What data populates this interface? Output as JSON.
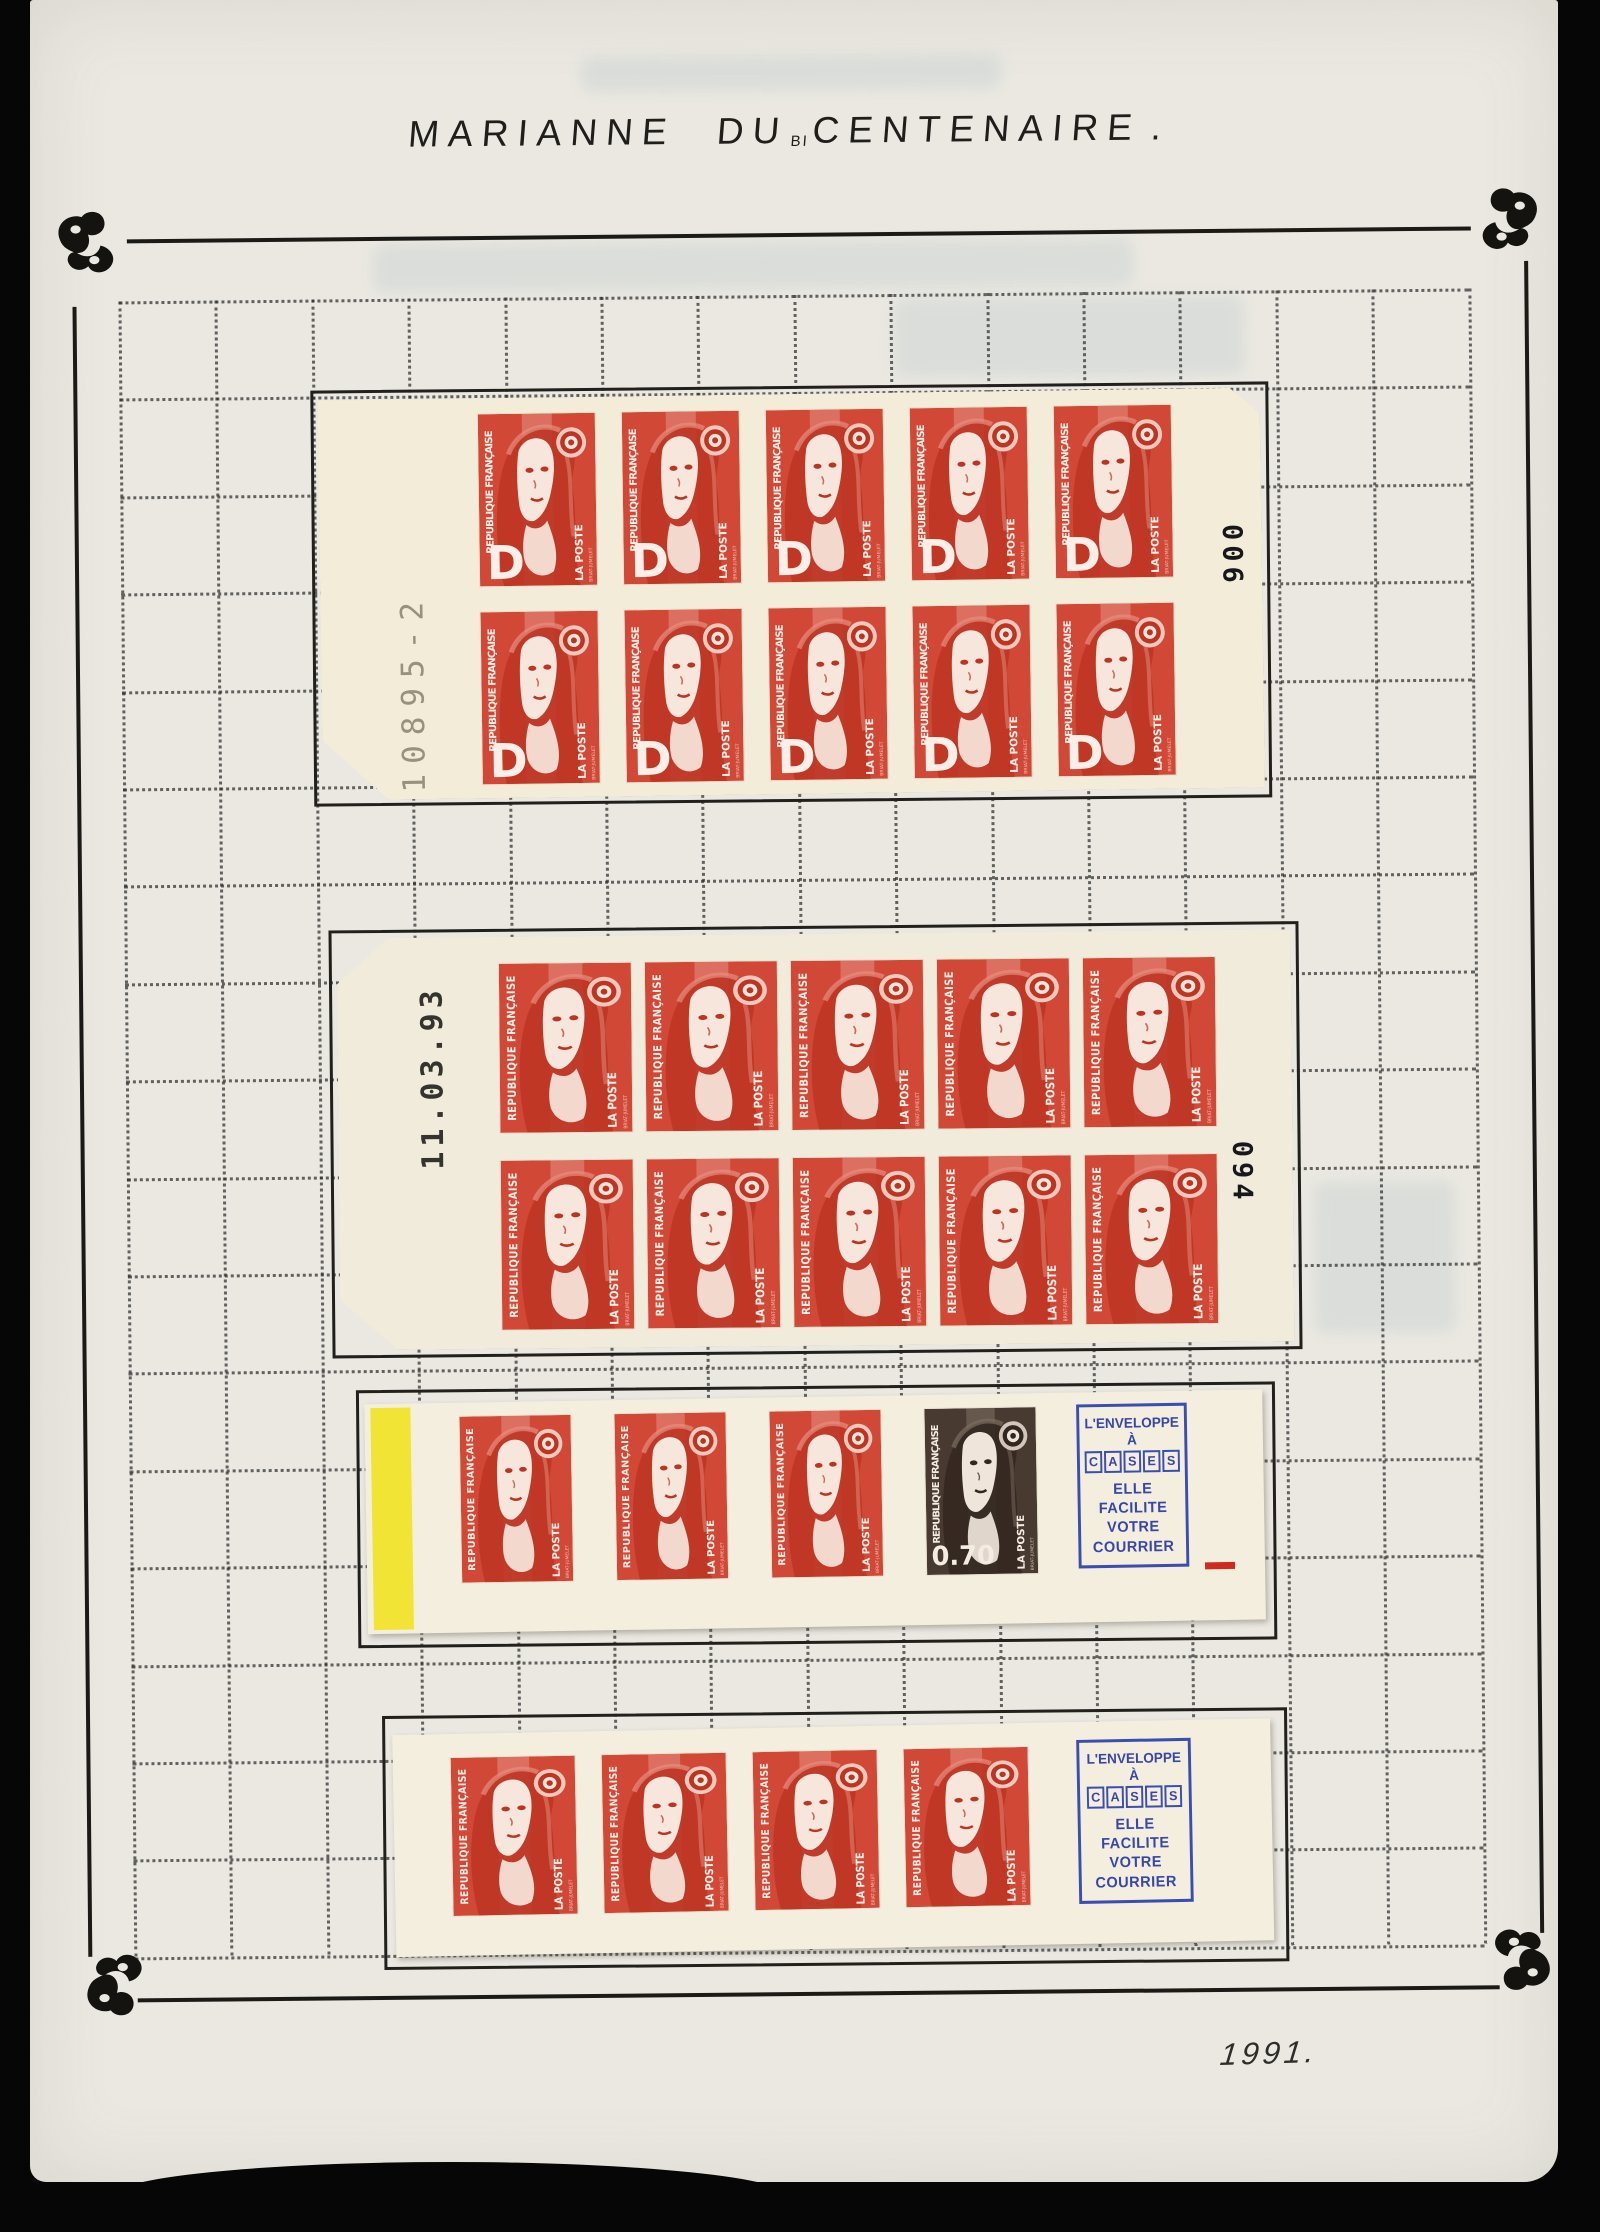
{
  "page_title": {
    "prefix": "MARIANNE DU",
    "small": "BI",
    "suffix": "CENTENAIRE",
    "period": "."
  },
  "year_note": "1991.",
  "stamp_text": {
    "country": "REPUBLIQUE FRANÇAISE",
    "post": "LA POSTE",
    "artist": "BRIAT-JUMELET",
    "letter_d": "D",
    "value_070": "0.70"
  },
  "cover": {
    "line1": "L'ENVELOPPE",
    "line2": "À",
    "boxed": "CASES",
    "line3": "ELLE",
    "line4": "FACILITE",
    "line5": "VOTRE",
    "line6": "COURRIER"
  },
  "booklets": [
    {
      "name": "pane-of-10-letter-D",
      "rows": 2,
      "cols": 5,
      "variant": "red",
      "letter": "D",
      "left_label": "10895-2",
      "right_label": "006"
    },
    {
      "name": "pane-of-10-tvp",
      "rows": 2,
      "cols": 5,
      "variant": "red",
      "letter": "",
      "left_label": "11.03.93",
      "right_label": "094"
    },
    {
      "name": "carnet-strip-070",
      "stamps": [
        "red",
        "red",
        "red",
        "brown070"
      ],
      "yellow_stripe": true
    },
    {
      "name": "carnet-strip-tvp",
      "stamps": [
        "red",
        "red",
        "red",
        "red"
      ],
      "yellow_stripe": false
    }
  ],
  "colors": {
    "stamp_red": "#d14836",
    "stamp_red_deep": "#bd3423",
    "stamp_brown": "#483a31",
    "carnet_blue": "#3b4db1",
    "yellow_stripe": "#f2e435",
    "pane_cream": "#f1ecd9",
    "page_paper": "#eae8e1",
    "mount_ink": "#1d1c1a"
  }
}
